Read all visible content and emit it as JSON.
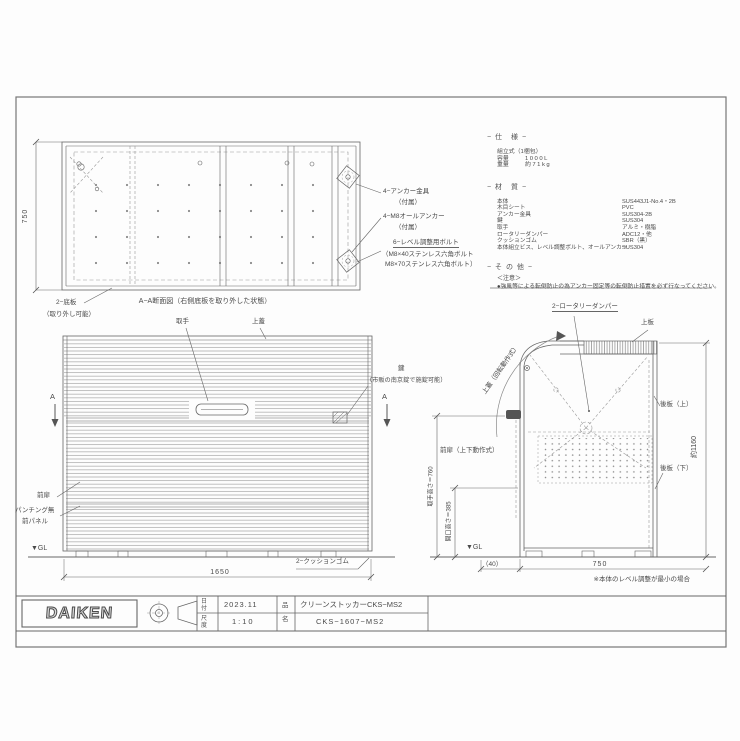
{
  "page": {
    "background": "#ffffff",
    "line_color": "#666666"
  },
  "specs": {
    "heading": "− 仕　様 −",
    "assembly": "組立式（1梱包）",
    "rows": [
      {
        "label": "容量",
        "value": "1000L"
      },
      {
        "label": "重量",
        "value": "約71kg"
      }
    ],
    "materials_heading": "− 材　質 −",
    "materials": [
      {
        "label": "本体",
        "value": "SUS443J1-No.4・2B"
      },
      {
        "label": "木目シート",
        "value": "PVC"
      },
      {
        "label": "アンカー金具",
        "value": "SUS304-2B"
      },
      {
        "label": "鍵",
        "value": "SUS304"
      },
      {
        "label": "取手",
        "value": "アルミ・樹脂"
      },
      {
        "label": "ロータリーダンパー",
        "value": "ADC12・他"
      },
      {
        "label": "クッションゴム",
        "value": "SBR（黒）"
      },
      {
        "label": "本体組立ビス、レベル調整ボルト、オールアンカー",
        "value": "SUS304"
      }
    ],
    "other_heading": "− そ の 他 −",
    "caution_title": "＜注意＞",
    "caution_text": "●強風等による転倒防止の為アンカー固定等の転倒防止措置を必ず行なってください。"
  },
  "section_view": {
    "caption": "A−A断面図（右側底板を取り外した状態）",
    "dim_depth": "750",
    "label_anchor": "4−アンカー金具",
    "label_anchor_sub": "（付属）",
    "label_allanchor": "4−M8オールアンカー",
    "label_allanchor_sub": "（付属）",
    "label_level_bolt": "6−レベル調整用ボルト",
    "label_level_bolt_sub1": "（M8×40ステンレス六角ボルト",
    "label_level_bolt_sub2": "M8×70ステンレス六角ボルト）",
    "label_bottom_plate": "2−底板",
    "label_bottom_plate_sub": "（取り外し可能）"
  },
  "front_view": {
    "label_handle": "取手",
    "label_lid": "上蓋",
    "label_key": "鍵",
    "label_key_sub": "（市販の南京錠で施錠可能）",
    "label_door": "前扉",
    "label_panel_line1": "パンチング無",
    "label_panel_line2": "前パネル",
    "gl": "▼GL",
    "dim_width": "1650",
    "label_cushion": "2−クッションゴム",
    "section_marker": "A"
  },
  "side_view": {
    "label_damper": "2−ロータリーダンパー",
    "label_top_plate": "上板",
    "label_lid_rotate": "上蓋（回転動作式）",
    "label_back_upper": "後板（上）",
    "label_back_lower": "後板（下）",
    "label_door": "前扉（上下動作式）",
    "dim_height": "約1160",
    "dim_handle_height": "取手高さ＝760",
    "dim_opening_height": "開口高さ＝385",
    "gl": "▼GL",
    "dim_offset": "（40）",
    "dim_depth": "750",
    "note": "※本体のレベル調整が最小の場合"
  },
  "title_block": {
    "logo": "DAIKEN",
    "date_label": "日付",
    "date_value": "2023.11",
    "scale_label": "尺度",
    "scale_value": "1:10",
    "name_label": "品名",
    "product_name": "クリーンストッカーCKS−MS2",
    "model": "CKS−1607−MS2"
  }
}
